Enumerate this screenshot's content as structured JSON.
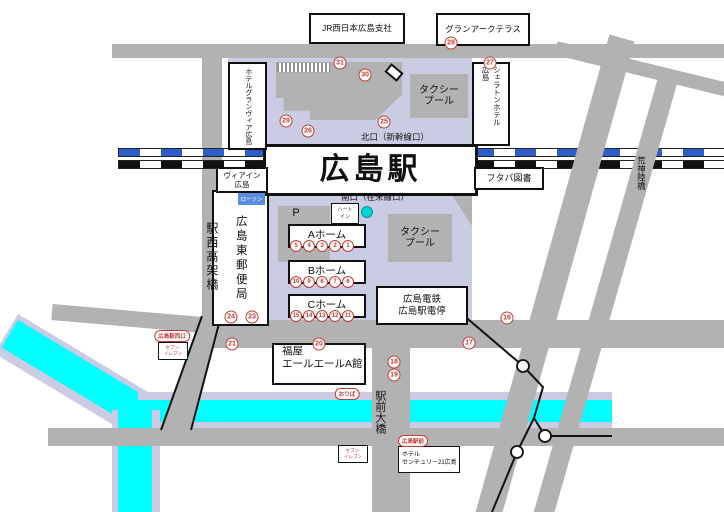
{
  "station": {
    "name": "広島駅"
  },
  "exits": {
    "north": "北口（新幹線口）",
    "south": "南口（在来線口）"
  },
  "roads": {
    "west_viaduct": "駅西高架橋",
    "kojin_bridge": "荒神陸橋",
    "ekimae_bridge": "駅前大橋"
  },
  "buildings": {
    "jr_west": "JR西日本広島支社",
    "grand_arc": "グランアークテラス",
    "granvia": "ホテルグランヴィア広島",
    "sheraton_left": "広島",
    "sheraton_right": "シェラトンホテル",
    "via_inn_1": "ヴィアイン",
    "via_inn_2": "広島",
    "futaba": "フタバ図書",
    "post_office": "広島東郵便局",
    "lawson": "ローソン",
    "heart_in_1": "ハート",
    "heart_in_2": "イン",
    "parking": "P",
    "taxi_pool_1": "タクシー",
    "taxi_pool_2": "プール",
    "fukuya_1": "福屋",
    "fukuya_2": "エールエールA館",
    "hiroden_1": "広島電鉄",
    "hiroden_2": "広島駅電停",
    "century_1": "ホテル",
    "century_2": "センチュリー21広島",
    "seven_1": "セブン-",
    "seven_2": "イレブン"
  },
  "badges": {
    "west_exit": "広島駅西口",
    "oriba": "おりば",
    "ekimae": "広島駅前"
  },
  "platforms": [
    {
      "name": "Aホーム",
      "stops": [
        "5",
        "4",
        "3",
        "2",
        "1"
      ]
    },
    {
      "name": "Bホーム",
      "stops": [
        "10",
        "9",
        "8",
        "7",
        "6"
      ]
    },
    {
      "name": "Cホーム",
      "stops": [
        "15",
        "14",
        "13",
        "12",
        "11"
      ]
    }
  ],
  "bus_stops": {
    "s16": "16",
    "s17": "17",
    "s18": "18",
    "s19": "19",
    "s20": "20",
    "s21": "21",
    "s23": "23",
    "s24": "24",
    "s25": "25",
    "s26": "26",
    "s27": "27",
    "s28": "28",
    "s29": "29",
    "s30": "30",
    "s31": "31"
  },
  "colors": {
    "road": "#b2b2b2",
    "plaza": "#c9cce3",
    "river": "#00ffff",
    "riverbank": "#c9cce3",
    "track_blue": "#2e5ec9",
    "track_dark": "#111111",
    "stop_red": "#c33b33",
    "lawson_blue": "#5b8ede",
    "dot_teal": "#00cccc"
  }
}
